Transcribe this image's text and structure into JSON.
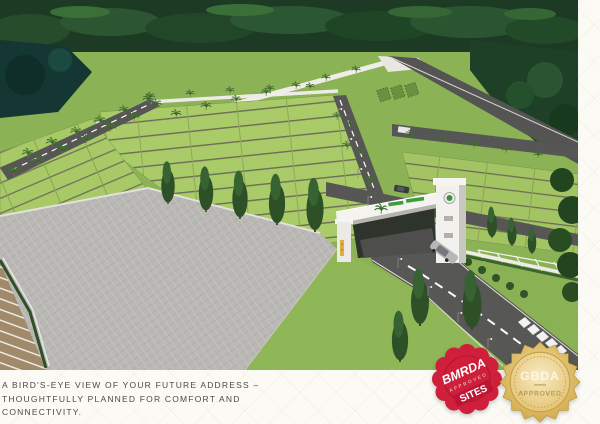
{
  "caption": {
    "lines": [
      "A BIRD'S-EYE VIEW OF YOUR FUTURE ADDRESS –",
      "THOUGHTFULLY PLANNED FOR COMFORT AND",
      "CONNECTIVITY."
    ],
    "text_color": "#4a4a4a"
  },
  "badges": {
    "bmrda": {
      "title": "BMRDA",
      "subtitle": "APPROVED",
      "label": "SITES",
      "color": "#d2203c"
    },
    "gbda": {
      "title": "GBDA",
      "subtitle": "APPROVED",
      "color": "#d4a94e"
    }
  },
  "palette": {
    "page_background": "#fcfaf4",
    "plot_green": "#a7c966",
    "grass_green": "#8bb254",
    "forest_green": "#1d3b24",
    "road_gray": "#565654",
    "paving_gray": "#bab8b4",
    "wall_white": "#edebe5",
    "gate_sign_green": "#3f9b40"
  }
}
